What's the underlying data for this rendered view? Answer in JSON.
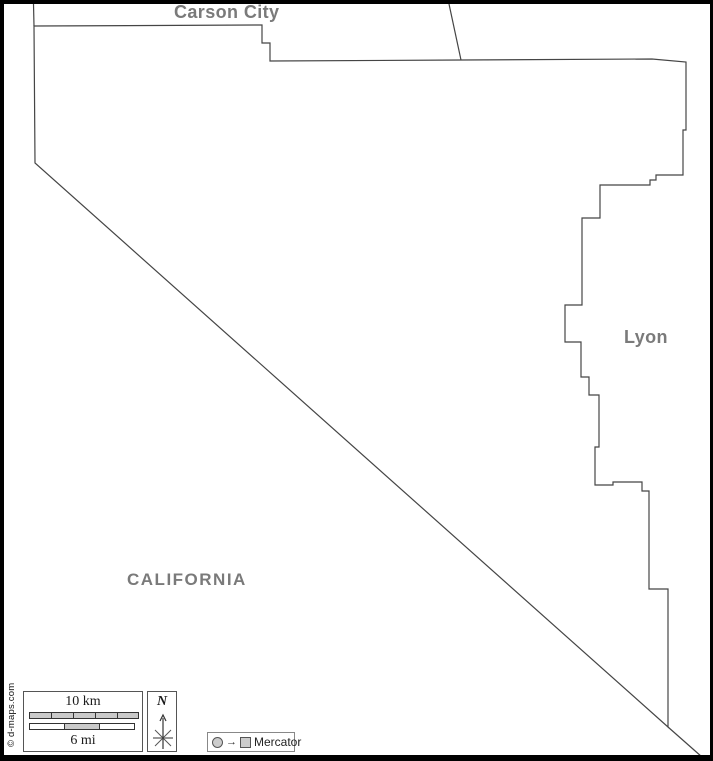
{
  "map": {
    "region_labels": {
      "carson_city": "Carson City",
      "lyon": "Lyon",
      "california": "CALIFORNIA"
    },
    "paths": {
      "county_outline": "M 34 26 L 262 25 L 262 43 L 270 43 L 270 61 L 461 60 L 652 59 L 686 62 L 686 130 L 683 130 L 683 175 L 656 175 L 656 180 L 650 180 L 650 185 L 600 185 L 600 218 L 582 218 L 582 305 L 565 305 L 565 342 L 581 342 L 581 377 L 589 377 L 589 395 L 599 395 L 599 447 L 595 447 L 595 485 L 613 485 L 613 482 L 642 482 L 642 491 L 649 491 L 649 589 L 668 589 L 668 727 L 35 163 Z",
      "carson_city_west_border": "M 33.5 4 L 34 26",
      "carson_lyon_border": "M 449 4 L 461 60",
      "california_border_extension": "M 668 727 L 702 757"
    },
    "colors": {
      "boundary_line": "#454545",
      "label_gray": "#7a7a7a",
      "frame_black": "#000000",
      "scalebar_fill": "#c9c9c9"
    }
  },
  "scale_bar": {
    "km_label": "10 km",
    "mi_label": "6 mi"
  },
  "compass": {
    "north_label": "N"
  },
  "projection_legend": {
    "arrow": "→",
    "label": "Mercator"
  },
  "copyright": "© d-maps.com"
}
